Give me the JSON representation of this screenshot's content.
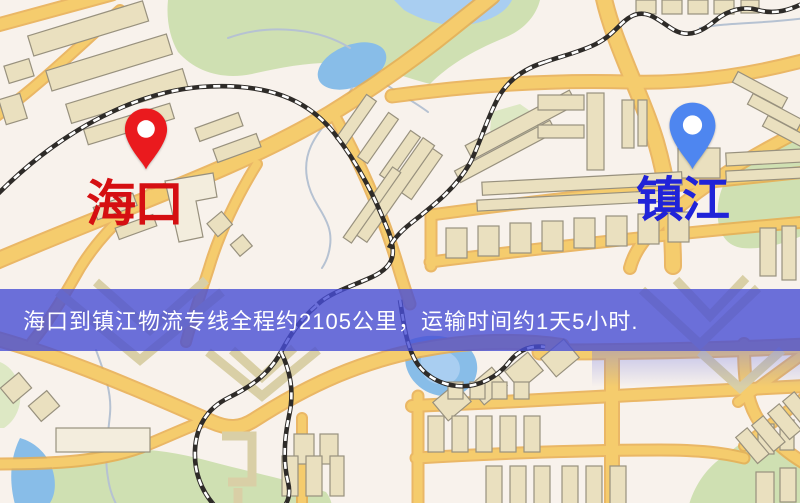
{
  "markers": {
    "origin": {
      "name": "海口",
      "label_color": "#d50f12",
      "pin_color": "#ea1a1e"
    },
    "destination": {
      "name": "镇江",
      "label_color": "#2023d8",
      "pin_color": "#4e86f0"
    }
  },
  "banner": {
    "text": "海口到镇江物流专线全程约2105公里，运输时间约1天5小时.",
    "bg": "rgba(71,77,212,0.80)",
    "text_color": "#ffffff"
  },
  "palette": {
    "bg": "#f8f2ec",
    "road": "#f5cc6d",
    "road_casing": "#e8ad4f",
    "building": "#eae0bf",
    "building_light": "#f3eddd",
    "building_outline": "#98917e",
    "building_stroke": "#d9cfa6",
    "park": "#cfe0b2",
    "park2": "#dde8c4",
    "water": "#88bde8",
    "water_light": "#a9cef1",
    "stream": "#b6c2d2",
    "rail_dark": "#2e2b28",
    "rail_light": "#ffffff"
  }
}
